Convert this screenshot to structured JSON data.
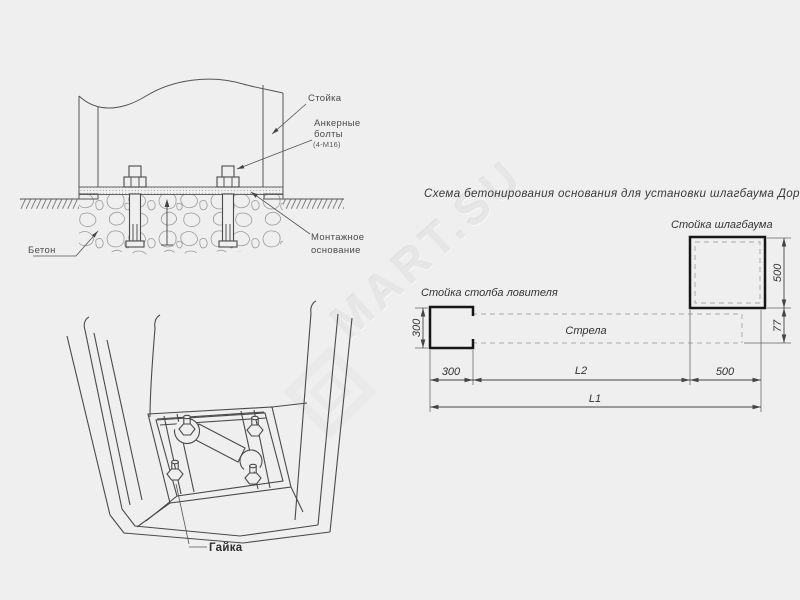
{
  "colors": {
    "background": "#efefef",
    "line": "#4a4a4a",
    "bold_line": "#161616",
    "dashed_line": "#a8a8a8",
    "text": "#3a3a3a",
    "watermark": "#e6e6e6"
  },
  "watermark": {
    "text": "MART.SU"
  },
  "elevation": {
    "labels": {
      "post": "Стойка",
      "anchor_bolts_line1": "Анкерные",
      "anchor_bolts_line2": "болты",
      "anchor_bolts_spec": "(4-М16)",
      "concrete": "Бетон",
      "mounting_base_line1": "Монтажное",
      "mounting_base_line2": "основание"
    }
  },
  "perspective": {
    "labels": {
      "nut": "Гайка"
    }
  },
  "plan": {
    "title": "Схема бетонирования основания для установки шлагбаума ДорХан",
    "labels": {
      "barrier_post": "Стойка шлагбаума",
      "catcher_post": "Стойка столба ловителя",
      "boom": "Стрела"
    },
    "dimensions": {
      "barrier_post_height": "500",
      "barrier_post_width": "500",
      "boom_height": "77",
      "catcher_post_height": "300",
      "catcher_post_width": "300",
      "span": "L2",
      "total_length": "L1"
    }
  }
}
